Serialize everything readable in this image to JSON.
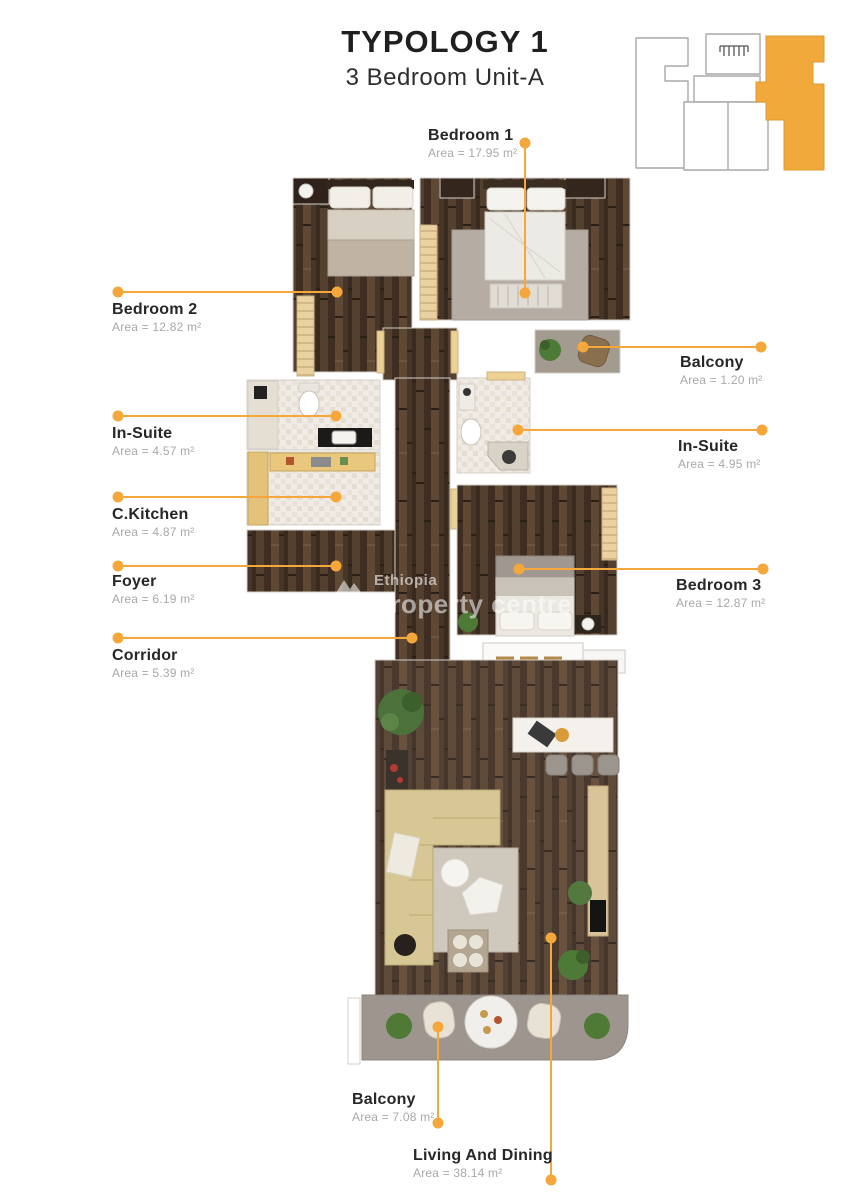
{
  "page": {
    "title": "TYPOLOGY 1",
    "subtitle": "3 Bedroom Unit-A"
  },
  "watermark": {
    "line1": "Ethiopia",
    "line2": "property centre"
  },
  "colors": {
    "accent_orange": "#F5A73C",
    "label_text": "#272727",
    "area_text": "#A8A8A8",
    "wood_dark": "#4A3629",
    "tile_light": "#F0ECE5",
    "concrete_gray": "#9E968E",
    "locator_unit_orange": "#F2A93B"
  },
  "labels": [
    {
      "name": "Bedroom 1",
      "area": "Area = 17.95 m²"
    },
    {
      "name": "Bedroom 2",
      "area": "Area = 12.82 m²"
    },
    {
      "name": "Balcony",
      "area": "Area = 1.20 m²"
    },
    {
      "name": "In-Suite",
      "area": "Area = 4.57 m²"
    },
    {
      "name": "In-Suite",
      "area": "Area = 4.95 m²"
    },
    {
      "name": "C.Kitchen",
      "area": "Area = 4.87 m²"
    },
    {
      "name": "Foyer",
      "area": "Area = 6.19 m²"
    },
    {
      "name": "Corridor",
      "area": "Area = 5.39 m²"
    },
    {
      "name": "Bedroom 3",
      "area": "Area = 12.87 m²"
    },
    {
      "name": "Balcony",
      "area": "Area = 7.08 m²"
    },
    {
      "name": "Living And Dining",
      "area": "Area = 38.14 m²"
    }
  ]
}
